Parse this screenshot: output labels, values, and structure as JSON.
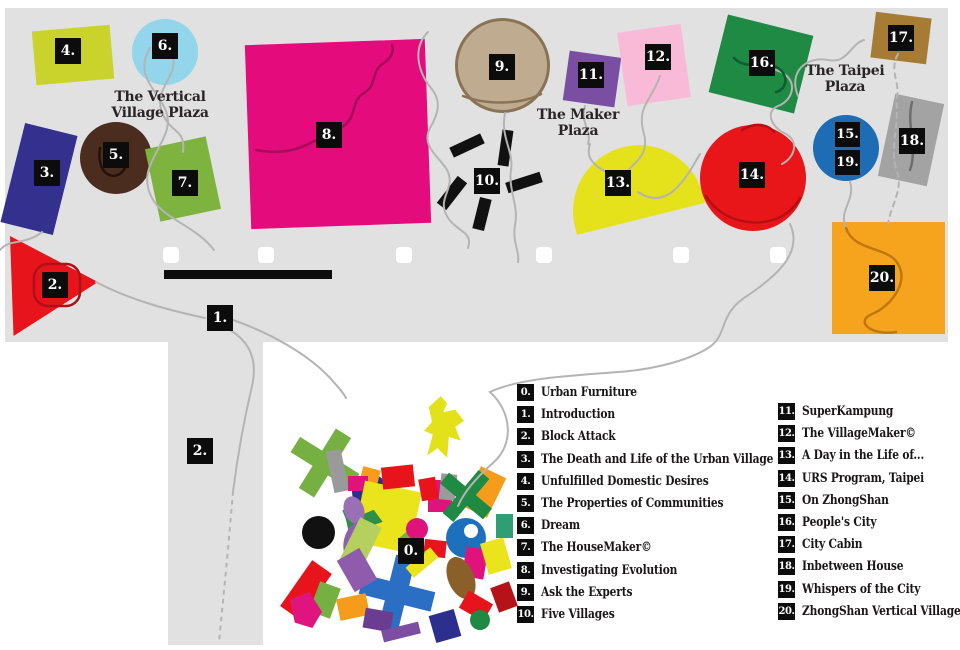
{
  "map": {
    "background_color": "#e1e1e1",
    "areas": [
      {
        "x": 5,
        "y": 8,
        "w": 943,
        "h": 334
      },
      {
        "x": 168,
        "y": 342,
        "w": 95,
        "h": 303
      }
    ],
    "plazas": [
      {
        "id": "vertical-village-plaza",
        "lines": [
          "The Vertical",
          "Village Plaza"
        ],
        "cx": 160,
        "y": 90
      },
      {
        "id": "maker-plaza",
        "lines": [
          "The Maker",
          "Plaza"
        ],
        "cx": 578,
        "y": 108
      },
      {
        "id": "taipei-plaza",
        "lines": [
          "The Taipei",
          "Plaza"
        ],
        "cx": 845,
        "y": 64
      }
    ],
    "shapes": [
      {
        "id": "4",
        "kind": "rect",
        "x": 34,
        "y": 28,
        "w": 78,
        "h": 54,
        "rot": -5,
        "color": "#c9d32b"
      },
      {
        "id": "6",
        "kind": "circle",
        "x": 132,
        "y": 19,
        "w": 66,
        "h": 66,
        "color": "#93d5ea"
      },
      {
        "id": "3",
        "kind": "rect",
        "x": 12,
        "y": 128,
        "w": 54,
        "h": 102,
        "rot": 14,
        "color": "#34308e"
      },
      {
        "id": "5",
        "kind": "circle",
        "x": 80,
        "y": 122,
        "w": 72,
        "h": 72,
        "color": "#4a2d1f"
      },
      {
        "id": "7",
        "kind": "rect",
        "x": 152,
        "y": 142,
        "w": 62,
        "h": 74,
        "rot": -12,
        "color": "#7db33e"
      },
      {
        "id": "8",
        "kind": "rect",
        "x": 248,
        "y": 42,
        "w": 180,
        "h": 184,
        "rot": -2,
        "color": "#e40b7d"
      },
      {
        "id": "2",
        "kind": "triangle",
        "x": 10,
        "y": 236,
        "w": 88,
        "h": 100,
        "points": "0 0, 100% 46%, 4% 100%",
        "color": "#e8141c"
      },
      {
        "id": "9",
        "kind": "circle",
        "x": 455,
        "y": 18,
        "w": 95,
        "h": 95,
        "color": "#bfab8f",
        "border": "3px solid #8a7355"
      },
      {
        "id": "10a",
        "kind": "rect",
        "x": 450,
        "y": 140,
        "w": 34,
        "h": 11,
        "rot": -25,
        "color": "#111111"
      },
      {
        "id": "10b",
        "kind": "rect",
        "x": 500,
        "y": 130,
        "w": 11,
        "h": 36,
        "rot": 8,
        "color": "#111111"
      },
      {
        "id": "10c",
        "kind": "rect",
        "x": 446,
        "y": 176,
        "w": 12,
        "h": 34,
        "rot": 38,
        "color": "#111111"
      },
      {
        "id": "10d",
        "kind": "rect",
        "x": 506,
        "y": 177,
        "w": 36,
        "h": 11,
        "rot": -18,
        "color": "#111111"
      },
      {
        "id": "10e",
        "kind": "rect",
        "x": 476,
        "y": 198,
        "w": 12,
        "h": 32,
        "rot": 14,
        "color": "#111111"
      },
      {
        "id": "11",
        "kind": "rect",
        "x": 566,
        "y": 54,
        "w": 52,
        "h": 50,
        "rot": 8,
        "color": "#7a4fa3"
      },
      {
        "id": "12",
        "kind": "rect",
        "x": 622,
        "y": 28,
        "w": 64,
        "h": 74,
        "rot": -8,
        "color": "#f8bad6"
      },
      {
        "id": "13",
        "kind": "dome",
        "x": 566,
        "y": 146,
        "w": 132,
        "h": 74,
        "rot": -14,
        "color": "#e5e21c"
      },
      {
        "id": "14",
        "kind": "circle",
        "x": 700,
        "y": 125,
        "w": 106,
        "h": 106,
        "color": "#e81519"
      },
      {
        "id": "16",
        "kind": "rect",
        "x": 717,
        "y": 24,
        "w": 88,
        "h": 80,
        "rot": 14,
        "color": "#1f8a44"
      },
      {
        "id": "17",
        "kind": "rect",
        "x": 873,
        "y": 15,
        "w": 56,
        "h": 46,
        "rot": 7,
        "color": "#a67b33"
      },
      {
        "id": "15-19",
        "kind": "circle",
        "x": 813,
        "y": 115,
        "w": 66,
        "h": 66,
        "color": "#1e6cb4"
      },
      {
        "id": "18",
        "kind": "rect",
        "x": 886,
        "y": 98,
        "w": 50,
        "h": 84,
        "rot": 12,
        "color": "#a3a3a3"
      },
      {
        "id": "20",
        "kind": "rect",
        "x": 832,
        "y": 222,
        "w": 113,
        "h": 112,
        "rot": 0,
        "color": "#f6a41e"
      }
    ],
    "cluster_pieces": [
      {
        "kind": "cross",
        "x": 290,
        "y": 428,
        "w": 70,
        "h": 70,
        "t": 18,
        "rot": 32,
        "color": "#76b043"
      },
      {
        "kind": "blob",
        "x": 424,
        "y": 396,
        "w": 40,
        "h": 62,
        "rot": 0,
        "color": "#e3e21a",
        "points": "42% 0,58% 12%,48% 26%,78% 22%,100% 40%,78% 50%,92% 72%,62% 66%,58% 100%,34% 84%,8% 96%,22% 62%,0 56%,20% 42%,12% 18%"
      },
      {
        "kind": "rect",
        "x": 330,
        "y": 450,
        "w": 15,
        "h": 42,
        "rot": -12,
        "color": "#9a9a9a"
      },
      {
        "kind": "circle",
        "x": 352,
        "y": 474,
        "w": 36,
        "h": 36,
        "color": "#2d2f8f"
      },
      {
        "kind": "circle",
        "x": 302,
        "y": 516,
        "w": 33,
        "h": 33,
        "color": "#111111"
      },
      {
        "kind": "rect",
        "x": 294,
        "y": 562,
        "w": 24,
        "h": 56,
        "rot": 35,
        "color": "#e8141c"
      },
      {
        "kind": "rect",
        "x": 360,
        "y": 468,
        "w": 18,
        "h": 24,
        "rot": 15,
        "color": "#f59c1b"
      },
      {
        "kind": "rect",
        "x": 348,
        "y": 476,
        "w": 20,
        "h": 15,
        "rot": 0,
        "color": "#e0137d"
      },
      {
        "kind": "rect",
        "x": 358,
        "y": 486,
        "w": 58,
        "h": 62,
        "rot": 12,
        "color": "#e9e41b"
      },
      {
        "kind": "blob",
        "x": 340,
        "y": 506,
        "w": 42,
        "h": 28,
        "rot": 20,
        "color": "#2f8f46",
        "points": "0 40%,25% 20%,45% 35%,70% 0,100% 30%,75% 60%,95% 85%,55% 75%,30% 100%,15% 65%"
      },
      {
        "kind": "ellipse",
        "x": 344,
        "y": 496,
        "w": 20,
        "h": 28,
        "rot": -20,
        "color": "#9a6fb5"
      },
      {
        "kind": "ellipse",
        "x": 344,
        "y": 522,
        "w": 22,
        "h": 38,
        "rot": 15,
        "color": "#8e5fae"
      },
      {
        "kind": "rect",
        "x": 348,
        "y": 520,
        "w": 24,
        "h": 50,
        "rot": 26,
        "color": "#b5d05e"
      },
      {
        "kind": "rect",
        "x": 382,
        "y": 466,
        "w": 32,
        "h": 22,
        "rot": -6,
        "color": "#e8141c"
      },
      {
        "kind": "rect",
        "x": 428,
        "y": 480,
        "w": 24,
        "h": 32,
        "rot": 0,
        "color": "#e0137d"
      },
      {
        "kind": "rect",
        "x": 440,
        "y": 474,
        "w": 16,
        "h": 26,
        "rot": 6,
        "color": "#9a9a9a"
      },
      {
        "kind": "rect",
        "x": 420,
        "y": 478,
        "w": 17,
        "h": 22,
        "rot": -10,
        "color": "#e8141c"
      },
      {
        "kind": "rect",
        "x": 470,
        "y": 470,
        "w": 28,
        "h": 44,
        "rot": 26,
        "color": "#f59c1b"
      },
      {
        "kind": "cross",
        "x": 438,
        "y": 468,
        "w": 56,
        "h": 56,
        "t": 14,
        "rot": 40,
        "color": "#1f8a44"
      },
      {
        "kind": "circle",
        "x": 446,
        "y": 518,
        "w": 40,
        "h": 40,
        "color": "#1d71bc"
      },
      {
        "kind": "circle",
        "x": 464,
        "y": 524,
        "w": 14,
        "h": 14,
        "color": "#ffffff"
      },
      {
        "kind": "rect",
        "x": 464,
        "y": 548,
        "w": 22,
        "h": 30,
        "rot": 10,
        "color": "#e0137d"
      },
      {
        "kind": "rect",
        "x": 484,
        "y": 540,
        "w": 24,
        "h": 32,
        "rot": -16,
        "color": "#e9e41b"
      },
      {
        "kind": "ellipse",
        "x": 448,
        "y": 556,
        "w": 26,
        "h": 44,
        "rot": -22,
        "color": "#8a5f2a"
      },
      {
        "kind": "rect",
        "x": 424,
        "y": 540,
        "w": 22,
        "h": 17,
        "rot": 6,
        "color": "#e8141c"
      },
      {
        "kind": "rect",
        "x": 496,
        "y": 514,
        "w": 17,
        "h": 24,
        "rot": 0,
        "color": "#2f9e75"
      },
      {
        "kind": "cross",
        "x": 360,
        "y": 556,
        "w": 74,
        "h": 74,
        "t": 20,
        "rot": 14,
        "color": "#2a6fc4"
      },
      {
        "kind": "rect",
        "x": 344,
        "y": 552,
        "w": 26,
        "h": 36,
        "rot": -30,
        "color": "#8e5bad"
      },
      {
        "kind": "rect",
        "x": 314,
        "y": 584,
        "w": 22,
        "h": 32,
        "rot": 20,
        "color": "#76b043"
      },
      {
        "kind": "rect",
        "x": 338,
        "y": 596,
        "w": 30,
        "h": 22,
        "rot": -12,
        "color": "#f59c1b"
      },
      {
        "kind": "blob",
        "x": 290,
        "y": 592,
        "w": 32,
        "h": 36,
        "rot": 0,
        "color": "#e0147e",
        "points": "0 20%,60% 0,100% 55%,70% 100%,15% 85%"
      },
      {
        "kind": "rect",
        "x": 364,
        "y": 610,
        "w": 28,
        "h": 20,
        "rot": 10,
        "color": "#6a3d91"
      },
      {
        "kind": "rect",
        "x": 432,
        "y": 612,
        "w": 26,
        "h": 28,
        "rot": -16,
        "color": "#2d2f8f"
      },
      {
        "kind": "rect",
        "x": 462,
        "y": 596,
        "w": 28,
        "h": 20,
        "rot": 30,
        "color": "#e8141c"
      },
      {
        "kind": "rect",
        "x": 406,
        "y": 556,
        "w": 32,
        "h": 13,
        "rot": -40,
        "color": "#e9e41b"
      },
      {
        "kind": "rect",
        "x": 398,
        "y": 540,
        "w": 28,
        "h": 11,
        "rot": 50,
        "color": "#76b043"
      },
      {
        "kind": "circle",
        "x": 406,
        "y": 518,
        "w": 22,
        "h": 22,
        "color": "#e0137d"
      },
      {
        "kind": "rect",
        "x": 494,
        "y": 584,
        "w": 20,
        "h": 26,
        "rot": -20,
        "color": "#b5121a"
      },
      {
        "kind": "circle",
        "x": 470,
        "y": 610,
        "w": 20,
        "h": 20,
        "color": "#1f8a44"
      },
      {
        "kind": "rect",
        "x": 382,
        "y": 626,
        "w": 38,
        "h": 12,
        "rot": -14,
        "color": "#7b4ea1"
      }
    ],
    "chips": [
      {
        "text": "4.",
        "x": 55,
        "y": 38
      },
      {
        "text": "6.",
        "x": 152,
        "y": 33
      },
      {
        "text": "3.",
        "x": 34,
        "y": 160
      },
      {
        "text": "5.",
        "x": 103,
        "y": 142
      },
      {
        "text": "7.",
        "x": 172,
        "y": 170
      },
      {
        "text": "8.",
        "x": 316,
        "y": 122
      },
      {
        "text": "2.",
        "x": 42,
        "y": 272
      },
      {
        "text": "1.",
        "x": 207,
        "y": 305
      },
      {
        "text": "2.",
        "x": 187,
        "y": 438
      },
      {
        "text": "9.",
        "x": 489,
        "y": 54
      },
      {
        "text": "10.",
        "x": 474,
        "y": 168
      },
      {
        "text": "11.",
        "x": 578,
        "y": 62
      },
      {
        "text": "12.",
        "x": 645,
        "y": 44
      },
      {
        "text": "13.",
        "x": 605,
        "y": 170
      },
      {
        "text": "14.",
        "x": 739,
        "y": 162
      },
      {
        "text": "15.",
        "x": 835,
        "y": 122,
        "size": 25
      },
      {
        "text": "19.",
        "x": 835,
        "y": 150,
        "size": 25
      },
      {
        "text": "16.",
        "x": 749,
        "y": 50
      },
      {
        "text": "17.",
        "x": 888,
        "y": 25
      },
      {
        "text": "18.",
        "x": 899,
        "y": 128
      },
      {
        "text": "20.",
        "x": 869,
        "y": 265
      },
      {
        "text": "0.",
        "x": 398,
        "y": 538
      }
    ],
    "white_markers": {
      "y": 247,
      "size": 16,
      "xs": [
        163,
        258,
        396,
        536,
        673,
        770
      ]
    },
    "black_bar": {
      "x": 164,
      "y": 270,
      "w": 168,
      "h": 9
    }
  },
  "legend": {
    "columns": [
      {
        "x": 517,
        "y": 384,
        "items": [
          {
            "num": "0.",
            "label": "Urban Furniture"
          },
          {
            "num": "1.",
            "label": "Introduction"
          },
          {
            "num": "2.",
            "label": "Block Attack"
          },
          {
            "num": "3.",
            "label": "The Death and Life of the Urban Village"
          },
          {
            "num": "4.",
            "label": "Unfulfilled Domestic Desires"
          },
          {
            "num": "5.",
            "label": "The Properties of Communities"
          },
          {
            "num": "6.",
            "label": "Dream"
          },
          {
            "num": "7.",
            "label": "The HouseMaker©"
          },
          {
            "num": "8.",
            "label": "Investigating Evolution"
          },
          {
            "num": "9.",
            "label": "Ask the Experts"
          },
          {
            "num": "10.",
            "label": "Five Villages"
          }
        ]
      },
      {
        "x": 778,
        "y": 403,
        "items": [
          {
            "num": "11.",
            "label": "SuperKampung"
          },
          {
            "num": "12.",
            "label": "The VillageMaker©"
          },
          {
            "num": "13.",
            "label": "A Day in the Life of..."
          },
          {
            "num": "14.",
            "label": "URS Program, Taipei"
          },
          {
            "num": "15.",
            "label": "On ZhongShan"
          },
          {
            "num": "16.",
            "label": "People's City"
          },
          {
            "num": "17.",
            "label": "City Cabin"
          },
          {
            "num": "18.",
            "label": "Inbetween House"
          },
          {
            "num": "19.",
            "label": "Whispers of the City"
          },
          {
            "num": "20.",
            "label": "ZhongShan Vertical Village"
          }
        ]
      }
    ]
  }
}
